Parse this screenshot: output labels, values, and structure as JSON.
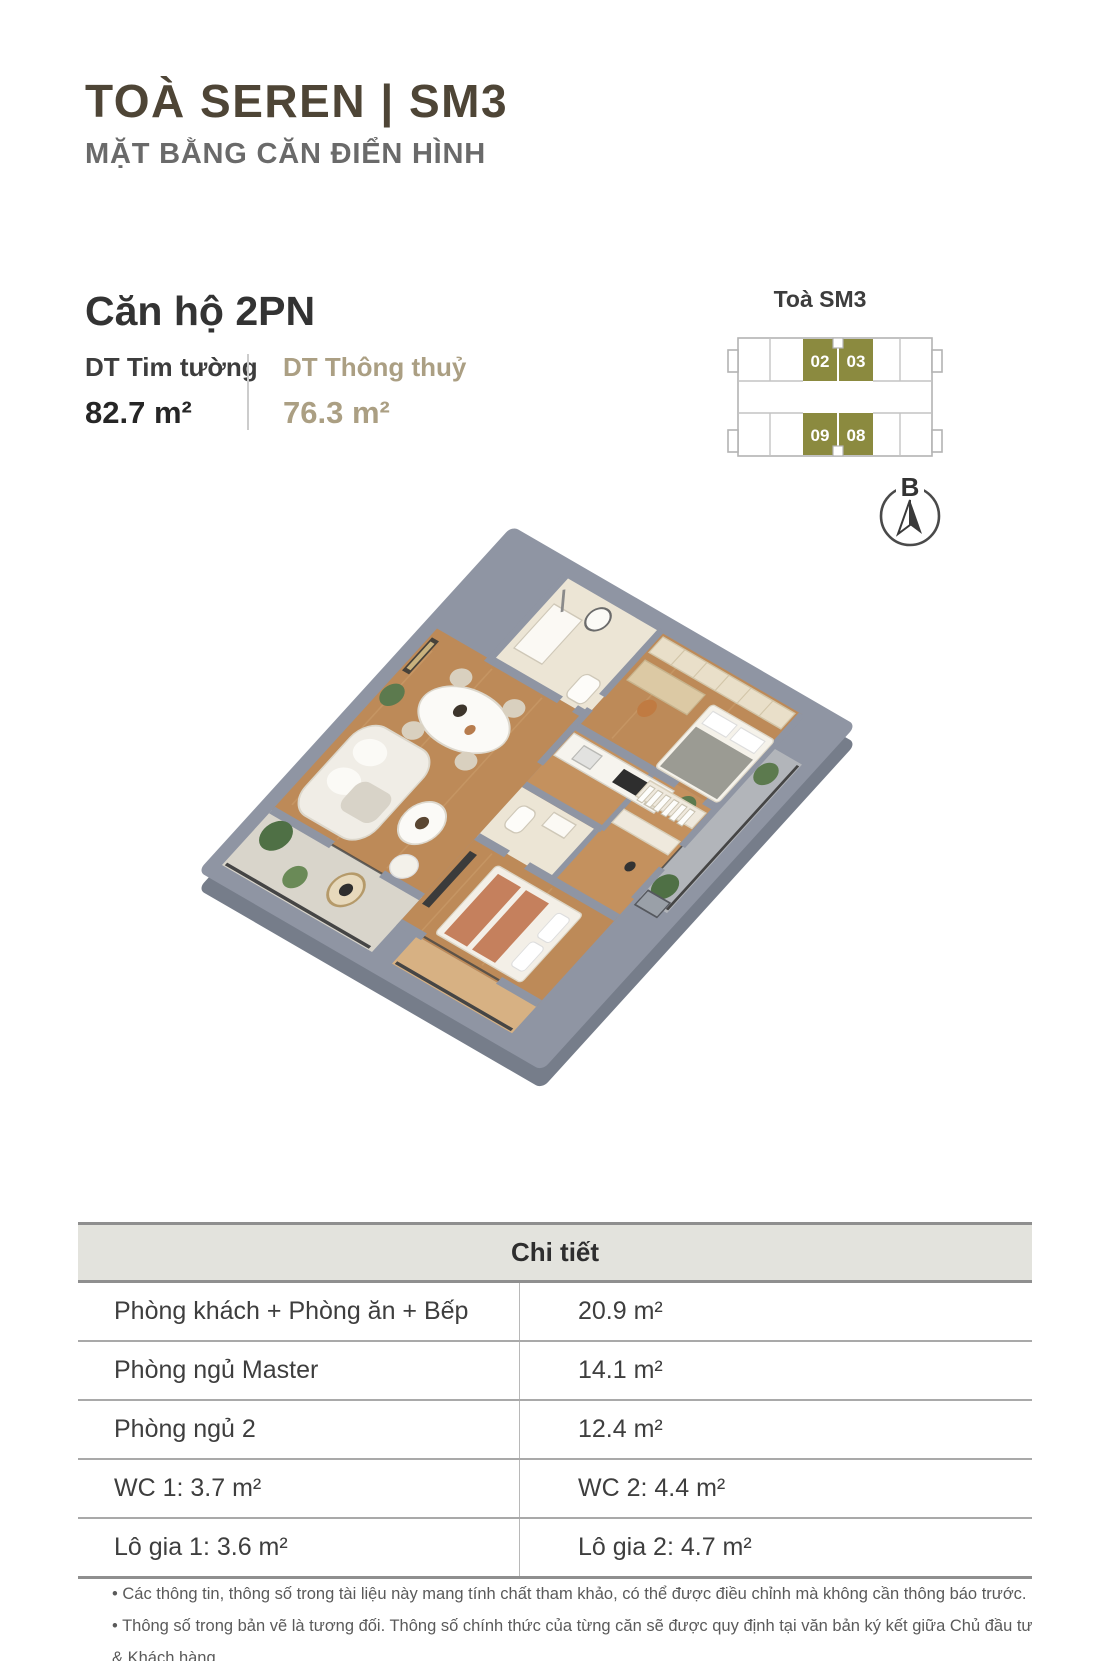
{
  "header": {
    "title": "TOÀ SEREN | SM3",
    "subtitle": "MẶT BẰNG CĂN ĐIỂN HÌNH"
  },
  "unit": {
    "name": "Căn hộ 2PN",
    "specs": [
      {
        "label": "DT Tim tường",
        "value": "82.7 m²"
      },
      {
        "label": "DT Thông thuỷ",
        "value": "76.3 m²"
      }
    ]
  },
  "minimap": {
    "title": "Toà SM3",
    "units": [
      {
        "label": "02"
      },
      {
        "label": "03"
      },
      {
        "label": "09"
      },
      {
        "label": "08"
      }
    ]
  },
  "compass": {
    "label": "B"
  },
  "table": {
    "header": "Chi tiết",
    "rows": [
      {
        "left": "Phòng khách + Phòng ăn + Bếp",
        "right": "20.9 m²"
      },
      {
        "left": "Phòng ngủ Master",
        "right": "14.1 m²"
      },
      {
        "left": "Phòng ngủ 2",
        "right": "12.4 m²"
      },
      {
        "left": "WC 1: 3.7 m²",
        "right": "WC 2: 4.4 m²"
      },
      {
        "left": "Lô gia 1: 3.6 m²",
        "right": "Lô gia 2: 4.7 m²"
      }
    ]
  },
  "notes": [
    "• Các thông tin, thông số trong tài liệu này mang tính chất tham khảo, có thể được điều chỉnh mà không cần thông báo trước.",
    "• Thông số trong bản vẽ là tương đối. Thông số chính thức của từng căn sẽ được quy định tại văn bản ký kết giữa Chủ đầu tư & Khách hàng."
  ],
  "colors": {
    "accent_olive": "#8b8a3f",
    "accent_tan": "#ab9f83",
    "title_brown": "#4e4536",
    "text_dark": "#3a3a3a",
    "wall_gray": "#8f95a3",
    "wood": "#bd8a58",
    "table_header_bg": "#e3e3dd"
  }
}
